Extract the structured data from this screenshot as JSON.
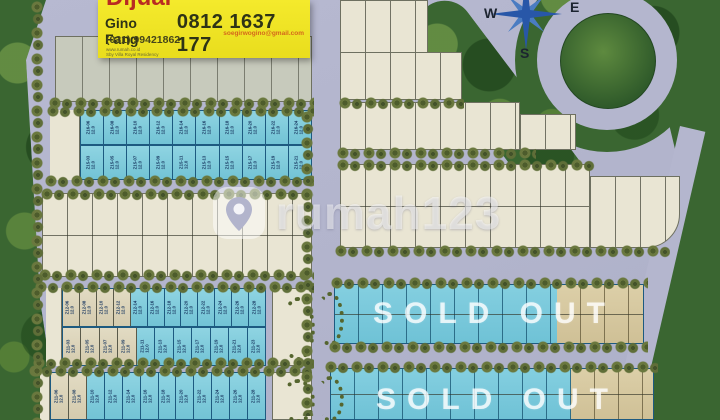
{
  "sign": {
    "headline_partial": "Dijual",
    "agent": "Gino Fang",
    "phone_main": "0812 1637 177",
    "email": "soegirwogino@gmail.com",
    "phone_office": "(031) 99421862",
    "fineprint_line1": "www.rumah.co.id",
    "fineprint_line2": "Sby Villa Royal Residency"
  },
  "compass": {
    "west": "W",
    "east": "E",
    "south": "S"
  },
  "watermark": {
    "brand": "rumah123"
  },
  "sold_out": {
    "label": "SOLD OUT"
  },
  "colors": {
    "road": "#b4b6ce",
    "lot_cream": "#e9e5d3",
    "lot_cyan": "#7ecfdf",
    "lot_beige": "#ddd5bb",
    "lot_tan": "#d7c9a2",
    "forest_green": "#3a6631",
    "sign_yellow": "#f1e724",
    "sold_out_text": "rgba(255,255,255,0.78)"
  },
  "lots": {
    "z16_row": [
      {
        "id": "Z16-06",
        "size": "12.0",
        "cls": "cyan"
      },
      {
        "id": "Z16-08",
        "size": "12.0",
        "cls": "cyan"
      },
      {
        "id": "Z16-10",
        "size": "12.0",
        "cls": "cyan"
      },
      {
        "id": "Z16-12",
        "size": "12.0",
        "cls": "cyan"
      },
      {
        "id": "Z16-14",
        "size": "12.0",
        "cls": "cyan"
      },
      {
        "id": "Z16-16",
        "size": "12.0",
        "cls": "cyan"
      },
      {
        "id": "Z16-18",
        "size": "12.0",
        "cls": "cyan"
      },
      {
        "id": "Z16-20",
        "size": "12.0",
        "cls": "cyan"
      },
      {
        "id": "Z16-22",
        "size": "12.0",
        "cls": "cyan"
      },
      {
        "id": "Z16-24",
        "size": "12.0",
        "cls": "cyan"
      }
    ],
    "z15_row": [
      {
        "id": "Z15-03",
        "size": "12.0",
        "cls": "cyan"
      },
      {
        "id": "Z15-05",
        "size": "12.0",
        "cls": "cyan"
      },
      {
        "id": "Z15-07",
        "size": "12.0",
        "cls": "cyan"
      },
      {
        "id": "Z15-09",
        "size": "12.0",
        "cls": "cyan"
      },
      {
        "id": "Z15-11",
        "size": "12.0",
        "cls": "cyan"
      },
      {
        "id": "Z15-13",
        "size": "12.0",
        "cls": "cyan"
      },
      {
        "id": "Z15-15",
        "size": "12.0",
        "cls": "cyan"
      },
      {
        "id": "Z15-17",
        "size": "12.0",
        "cls": "cyan"
      },
      {
        "id": "Z15-19",
        "size": "12.0",
        "cls": "cyan"
      },
      {
        "id": "Z15-21",
        "size": "12.0",
        "cls": "cyan"
      }
    ],
    "z12_row": [
      {
        "id": "Z12-06",
        "size": "12.0",
        "cls": "beige"
      },
      {
        "id": "Z12-08",
        "size": "12.0",
        "cls": "beige"
      },
      {
        "id": "Z12-10",
        "size": "12.0",
        "cls": "beige"
      },
      {
        "id": "Z12-12",
        "size": "12.0",
        "cls": "beige"
      },
      {
        "id": "Z12-14",
        "size": "12.0",
        "cls": "cyan"
      },
      {
        "id": "Z12-16",
        "size": "12.0",
        "cls": "cyan"
      },
      {
        "id": "Z12-18",
        "size": "12.0",
        "cls": "cyan"
      },
      {
        "id": "Z12-20",
        "size": "12.0",
        "cls": "cyan"
      },
      {
        "id": "Z12-22",
        "size": "12.0",
        "cls": "cyan"
      },
      {
        "id": "Z12-24",
        "size": "12.0",
        "cls": "cyan"
      },
      {
        "id": "Z12-26",
        "size": "12.0",
        "cls": "cyan"
      },
      {
        "id": "Z12-28",
        "size": "12.0",
        "cls": "cyan"
      }
    ],
    "z11_odd_row": [
      {
        "id": "Z11-03",
        "size": "12.0",
        "cls": "beige"
      },
      {
        "id": "Z11-05",
        "size": "12.0",
        "cls": "beige"
      },
      {
        "id": "Z11-07",
        "size": "12.0",
        "cls": "beige"
      },
      {
        "id": "Z11-09",
        "size": "12.0",
        "cls": "beige"
      },
      {
        "id": "Z11-11",
        "size": "12.0",
        "cls": "cyan"
      },
      {
        "id": "Z11-13",
        "size": "12.0",
        "cls": "cyan"
      },
      {
        "id": "Z11-15",
        "size": "12.0",
        "cls": "cyan"
      },
      {
        "id": "Z11-17",
        "size": "12.0",
        "cls": "cyan"
      },
      {
        "id": "Z11-19",
        "size": "12.0",
        "cls": "cyan"
      },
      {
        "id": "Z11-21",
        "size": "12.0",
        "cls": "cyan"
      },
      {
        "id": "Z11-23",
        "size": "12.0",
        "cls": "cyan"
      }
    ],
    "z11_even_row": [
      {
        "id": "Z11-06",
        "size": "12.0",
        "cls": "beige"
      },
      {
        "id": "Z11-08",
        "size": "12.0",
        "cls": "beige"
      },
      {
        "id": "Z11-10",
        "size": "12.0",
        "cls": "cyan"
      },
      {
        "id": "Z11-12",
        "size": "12.0",
        "cls": "cyan"
      },
      {
        "id": "Z11-14",
        "size": "12.0",
        "cls": "cyan"
      },
      {
        "id": "Z11-16",
        "size": "12.0",
        "cls": "cyan"
      },
      {
        "id": "Z11-18",
        "size": "12.0",
        "cls": "cyan"
      },
      {
        "id": "Z11-20",
        "size": "12.0",
        "cls": "cyan"
      },
      {
        "id": "Z11-22",
        "size": "12.0",
        "cls": "cyan"
      },
      {
        "id": "Z11-24",
        "size": "12.0",
        "cls": "cyan"
      },
      {
        "id": "Z11-26",
        "size": "12.0",
        "cls": "cyan"
      },
      {
        "id": "Z11-28",
        "size": "12.0",
        "cls": "cyan"
      }
    ]
  }
}
